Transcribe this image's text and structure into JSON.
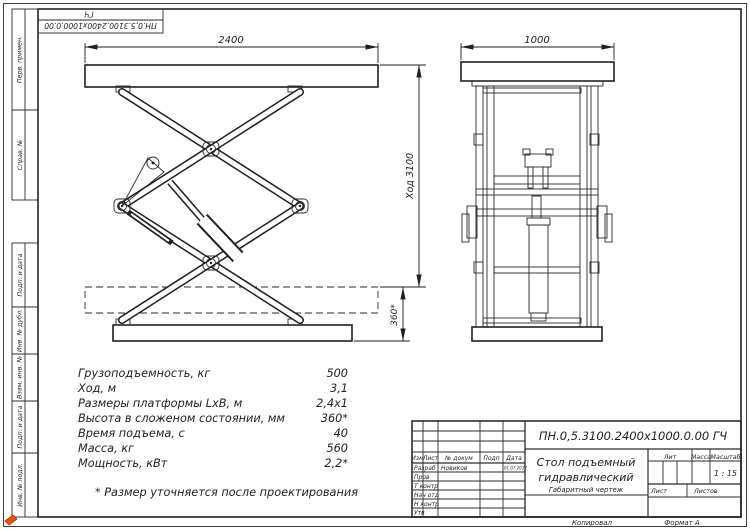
{
  "sheet": {
    "top_stamp": {
      "line1": "ГЧ",
      "line2": "ПН.0,5.3100.2400х1000.0.00"
    },
    "margin_labels": {
      "perv_primen": "Перв. примен.",
      "sprav_no": "Справ. №",
      "podp_data_1": "Подп. и дата",
      "inv_dubl": "Инв. № дубл.",
      "vzam_inv": "Взам. инв. №",
      "podp_data_2": "Подп. и дата",
      "inv_podl": "Инв. № подл."
    }
  },
  "drawing": {
    "front_view": {
      "width_dim": "2400",
      "stroke_dim": "Ход 3100",
      "closed_height_dim": "360*"
    },
    "side_view": {
      "width_dim": "1000"
    }
  },
  "specs": {
    "rows": [
      {
        "label": "Грузоподъемность, кг",
        "value": "500"
      },
      {
        "label": "Ход, м",
        "value": "3,1"
      },
      {
        "label": "Размеры платформы LхВ, м",
        "value": "2,4х1"
      },
      {
        "label": "Высота в сложеном состоянии, мм",
        "value": "360*"
      },
      {
        "label": "Время подъема, с",
        "value": "40"
      },
      {
        "label": "Масса, кг",
        "value": "560"
      },
      {
        "label": "Мощность, кВт",
        "value": "2,2*"
      }
    ],
    "footnote": "* Размер уточняется после проектирования"
  },
  "title_block": {
    "designation": "ПН.0,5.3100.2400х1000.0.00 ГЧ",
    "product_name_line1": "Стол подъемный",
    "product_name_line2": "гидравлический",
    "doc_type": "Габаритный чертеж",
    "header_cols": {
      "izm": "Изм",
      "list": "Лист",
      "no_dokum": "№ докум",
      "podp": "Подп",
      "data": "Дата"
    },
    "signature_rows": {
      "razrab_label": "Разраб",
      "razrab_name": "Новиков",
      "razrab_date": "01.07.2017",
      "prov_label": "Пров",
      "t_kontr_label": "Т контр",
      "nach_otd_label": "Нач отд",
      "n_kontr_label": "Н контр",
      "utv_label": "Утв"
    },
    "lit_label": "Лит",
    "mass_label": "Масса",
    "scale_label": "Масштаб",
    "scale_value": "1 : 15",
    "sheet_label": "Лист",
    "sheets_label": "Листов",
    "footer_copied": "Копировал",
    "footer_format": "Формат А"
  },
  "colors": {
    "line": "#1f1f1f",
    "logo_accent": "#e8500f"
  }
}
